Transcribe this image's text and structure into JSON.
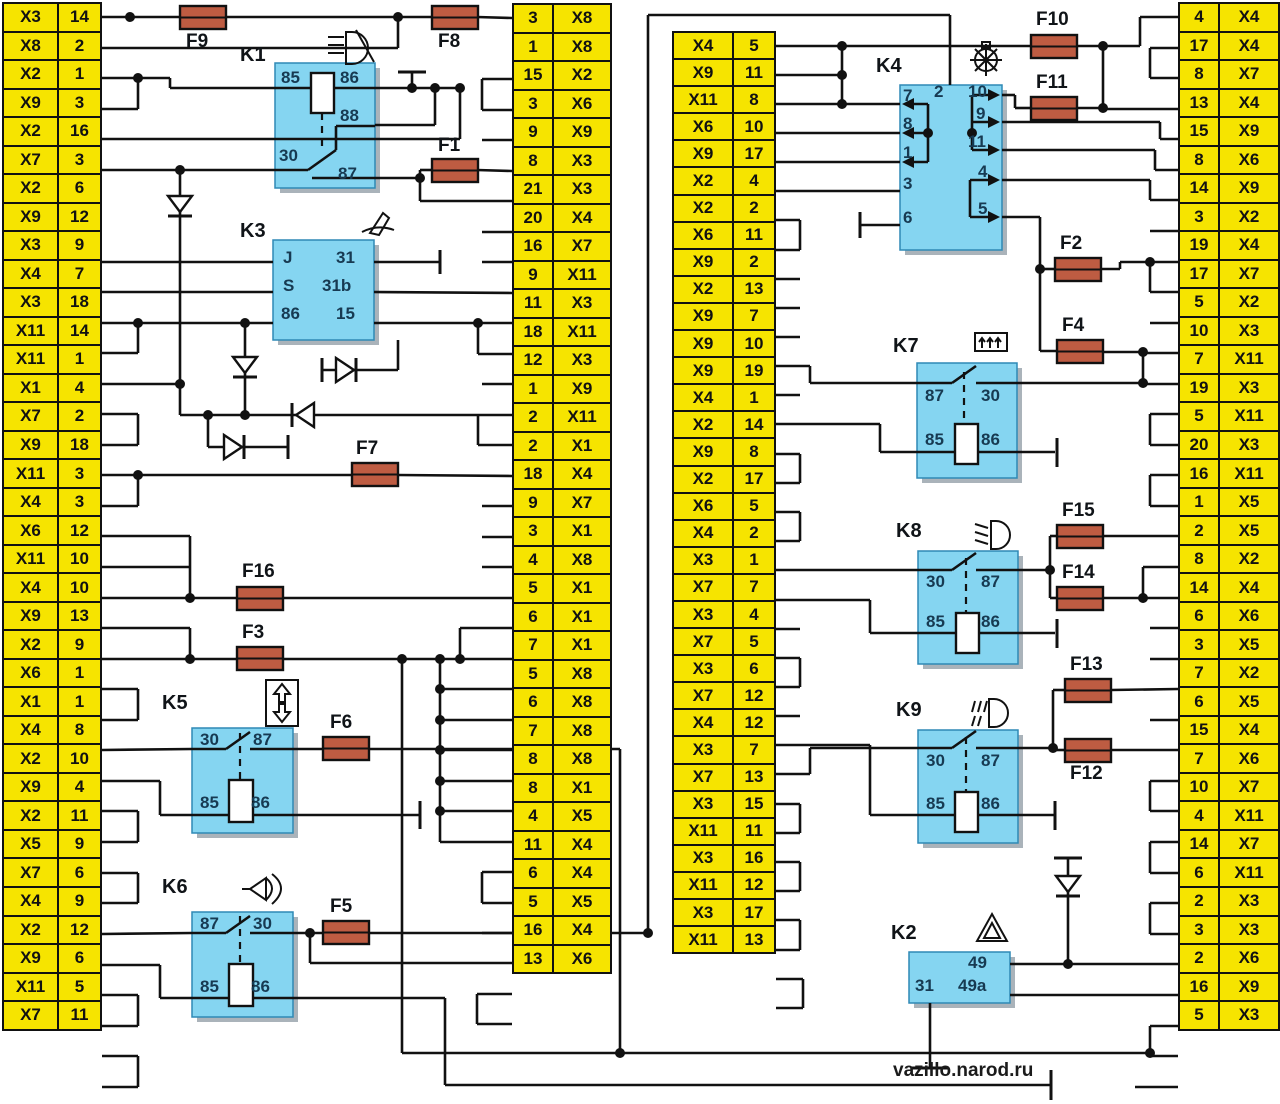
{
  "watermark": "vazillo.narod.ru",
  "colors": {
    "connector_yellow": "#F6E400",
    "relay_blue": "#85D5F1",
    "fuse_brown": "#BE5C42",
    "wire_black": "#111111",
    "background": "#FFFFFF"
  },
  "connector_columns": {
    "left": [
      {
        "conn": "X3",
        "pin": "14"
      },
      {
        "conn": "X8",
        "pin": "2"
      },
      {
        "conn": "X2",
        "pin": "1"
      },
      {
        "conn": "X9",
        "pin": "3"
      },
      {
        "conn": "X2",
        "pin": "16"
      },
      {
        "conn": "X7",
        "pin": "3"
      },
      {
        "conn": "X2",
        "pin": "6"
      },
      {
        "conn": "X9",
        "pin": "12"
      },
      {
        "conn": "X3",
        "pin": "9"
      },
      {
        "conn": "X4",
        "pin": "7"
      },
      {
        "conn": "X3",
        "pin": "18"
      },
      {
        "conn": "X11",
        "pin": "14"
      },
      {
        "conn": "X11",
        "pin": "1"
      },
      {
        "conn": "X1",
        "pin": "4"
      },
      {
        "conn": "X7",
        "pin": "2"
      },
      {
        "conn": "X9",
        "pin": "18"
      },
      {
        "conn": "X11",
        "pin": "3"
      },
      {
        "conn": "X4",
        "pin": "3"
      },
      {
        "conn": "X6",
        "pin": "12"
      },
      {
        "conn": "X11",
        "pin": "10"
      },
      {
        "conn": "X4",
        "pin": "10"
      },
      {
        "conn": "X9",
        "pin": "13"
      },
      {
        "conn": "X2",
        "pin": "9"
      },
      {
        "conn": "X6",
        "pin": "1"
      },
      {
        "conn": "X1",
        "pin": "1"
      },
      {
        "conn": "X4",
        "pin": "8"
      },
      {
        "conn": "X2",
        "pin": "10"
      },
      {
        "conn": "X9",
        "pin": "4"
      },
      {
        "conn": "X2",
        "pin": "11"
      },
      {
        "conn": "X5",
        "pin": "9"
      },
      {
        "conn": "X7",
        "pin": "6"
      },
      {
        "conn": "X4",
        "pin": "9"
      },
      {
        "conn": "X2",
        "pin": "12"
      },
      {
        "conn": "X9",
        "pin": "6"
      },
      {
        "conn": "X11",
        "pin": "5"
      },
      {
        "conn": "X7",
        "pin": "11"
      }
    ],
    "mid_left": [
      {
        "pin": "3",
        "conn": "X8"
      },
      {
        "pin": "1",
        "conn": "X8"
      },
      {
        "pin": "15",
        "conn": "X2"
      },
      {
        "pin": "3",
        "conn": "X6"
      },
      {
        "pin": "9",
        "conn": "X9"
      },
      {
        "pin": "8",
        "conn": "X3"
      },
      {
        "pin": "21",
        "conn": "X3"
      },
      {
        "pin": "20",
        "conn": "X4"
      },
      {
        "pin": "16",
        "conn": "X7"
      },
      {
        "pin": "9",
        "conn": "X11"
      },
      {
        "pin": "11",
        "conn": "X3"
      },
      {
        "pin": "18",
        "conn": "X11"
      },
      {
        "pin": "12",
        "conn": "X3"
      },
      {
        "pin": "1",
        "conn": "X9"
      },
      {
        "pin": "2",
        "conn": "X11"
      },
      {
        "pin": "2",
        "conn": "X1"
      },
      {
        "pin": "18",
        "conn": "X4"
      },
      {
        "pin": "9",
        "conn": "X7"
      },
      {
        "pin": "3",
        "conn": "X1"
      },
      {
        "pin": "4",
        "conn": "X8"
      },
      {
        "pin": "5",
        "conn": "X1"
      },
      {
        "pin": "6",
        "conn": "X1"
      },
      {
        "pin": "7",
        "conn": "X1"
      },
      {
        "pin": "5",
        "conn": "X8"
      },
      {
        "pin": "6",
        "conn": "X8"
      },
      {
        "pin": "7",
        "conn": "X8"
      },
      {
        "pin": "8",
        "conn": "X8"
      },
      {
        "pin": "8",
        "conn": "X1"
      },
      {
        "pin": "4",
        "conn": "X5"
      },
      {
        "pin": "11",
        "conn": "X4"
      },
      {
        "pin": "6",
        "conn": "X4"
      },
      {
        "pin": "5",
        "conn": "X5"
      },
      {
        "pin": "16",
        "conn": "X4"
      },
      {
        "pin": "13",
        "conn": "X6"
      }
    ],
    "mid_right": [
      {
        "conn": "X4",
        "pin": "5"
      },
      {
        "conn": "X9",
        "pin": "11"
      },
      {
        "conn": "X11",
        "pin": "8"
      },
      {
        "conn": "X6",
        "pin": "10"
      },
      {
        "conn": "X9",
        "pin": "17"
      },
      {
        "conn": "X2",
        "pin": "4"
      },
      {
        "conn": "X2",
        "pin": "2"
      },
      {
        "conn": "X6",
        "pin": "11"
      },
      {
        "conn": "X9",
        "pin": "2"
      },
      {
        "conn": "X2",
        "pin": "13"
      },
      {
        "conn": "X9",
        "pin": "7"
      },
      {
        "conn": "X9",
        "pin": "10"
      },
      {
        "conn": "X9",
        "pin": "19"
      },
      {
        "conn": "X4",
        "pin": "1"
      },
      {
        "conn": "X2",
        "pin": "14"
      },
      {
        "conn": "X9",
        "pin": "8"
      },
      {
        "conn": "X2",
        "pin": "17"
      },
      {
        "conn": "X6",
        "pin": "5"
      },
      {
        "conn": "X4",
        "pin": "2"
      },
      {
        "conn": "X3",
        "pin": "1"
      },
      {
        "conn": "X7",
        "pin": "7"
      },
      {
        "conn": "X3",
        "pin": "4"
      },
      {
        "conn": "X7",
        "pin": "5"
      },
      {
        "conn": "X3",
        "pin": "6"
      },
      {
        "conn": "X7",
        "pin": "12"
      },
      {
        "conn": "X4",
        "pin": "12"
      },
      {
        "conn": "X3",
        "pin": "7"
      },
      {
        "conn": "X7",
        "pin": "13"
      },
      {
        "conn": "X3",
        "pin": "15"
      },
      {
        "conn": "X11",
        "pin": "11"
      },
      {
        "conn": "X3",
        "pin": "16"
      },
      {
        "conn": "X11",
        "pin": "12"
      },
      {
        "conn": "X3",
        "pin": "17"
      },
      {
        "conn": "X11",
        "pin": "13"
      }
    ],
    "right": [
      {
        "pin": "4",
        "conn": "X4"
      },
      {
        "pin": "17",
        "conn": "X4"
      },
      {
        "pin": "8",
        "conn": "X7"
      },
      {
        "pin": "13",
        "conn": "X4"
      },
      {
        "pin": "15",
        "conn": "X9"
      },
      {
        "pin": "8",
        "conn": "X6"
      },
      {
        "pin": "14",
        "conn": "X9"
      },
      {
        "pin": "3",
        "conn": "X2"
      },
      {
        "pin": "19",
        "conn": "X4"
      },
      {
        "pin": "17",
        "conn": "X7"
      },
      {
        "pin": "5",
        "conn": "X2"
      },
      {
        "pin": "10",
        "conn": "X3"
      },
      {
        "pin": "7",
        "conn": "X11"
      },
      {
        "pin": "19",
        "conn": "X3"
      },
      {
        "pin": "5",
        "conn": "X11"
      },
      {
        "pin": "20",
        "conn": "X3"
      },
      {
        "pin": "16",
        "conn": "X11"
      },
      {
        "pin": "1",
        "conn": "X5"
      },
      {
        "pin": "2",
        "conn": "X5"
      },
      {
        "pin": "8",
        "conn": "X2"
      },
      {
        "pin": "14",
        "conn": "X4"
      },
      {
        "pin": "6",
        "conn": "X6"
      },
      {
        "pin": "3",
        "conn": "X5"
      },
      {
        "pin": "7",
        "conn": "X2"
      },
      {
        "pin": "6",
        "conn": "X5"
      },
      {
        "pin": "15",
        "conn": "X4"
      },
      {
        "pin": "7",
        "conn": "X6"
      },
      {
        "pin": "10",
        "conn": "X7"
      },
      {
        "pin": "4",
        "conn": "X11"
      },
      {
        "pin": "14",
        "conn": "X7"
      },
      {
        "pin": "6",
        "conn": "X11"
      },
      {
        "pin": "2",
        "conn": "X3"
      },
      {
        "pin": "3",
        "conn": "X3"
      },
      {
        "pin": "2",
        "conn": "X6"
      },
      {
        "pin": "16",
        "conn": "X9"
      },
      {
        "pin": "5",
        "conn": "X3"
      }
    ]
  },
  "relays": {
    "K1": {
      "name": "K1",
      "icon": "high-beam-headlight-icon",
      "terminals": [
        "85",
        "86",
        "88",
        "30",
        "87"
      ]
    },
    "K3": {
      "name": "K3",
      "icon": "wiper-icon",
      "terminals": [
        "J",
        "31",
        "S",
        "31b",
        "86",
        "15"
      ]
    },
    "K5": {
      "name": "K5",
      "icon": "power-window-icon",
      "terminals": [
        "30",
        "87",
        "85",
        "86"
      ]
    },
    "K6": {
      "name": "K6",
      "icon": "horn-icon",
      "terminals": [
        "87",
        "30",
        "85",
        "86"
      ]
    },
    "K4": {
      "name": "K4",
      "icon": "washer-fan-icon",
      "terminals": [
        "7",
        "2",
        "10",
        "8",
        "9",
        "1",
        "11",
        "3",
        "4",
        "5",
        "6"
      ]
    },
    "K7": {
      "name": "K7",
      "icon": "rear-defroster-icon",
      "terminals": [
        "87",
        "30",
        "85",
        "86"
      ]
    },
    "K8": {
      "name": "K8",
      "icon": "low-beam-headlight-icon",
      "terminals": [
        "30",
        "87",
        "85",
        "86"
      ]
    },
    "K9": {
      "name": "K9",
      "icon": "fog-light-icon",
      "terminals": [
        "30",
        "87",
        "85",
        "86"
      ]
    },
    "K2": {
      "name": "K2",
      "icon": "hazard-warning-icon",
      "terminals": [
        "49",
        "31",
        "49a"
      ]
    }
  },
  "fuses": [
    {
      "id": "F1",
      "label": "F1"
    },
    {
      "id": "F2",
      "label": "F2"
    },
    {
      "id": "F3",
      "label": "F3"
    },
    {
      "id": "F4",
      "label": "F4"
    },
    {
      "id": "F5",
      "label": "F5"
    },
    {
      "id": "F6",
      "label": "F6"
    },
    {
      "id": "F7",
      "label": "F7"
    },
    {
      "id": "F8",
      "label": "F8"
    },
    {
      "id": "F9",
      "label": "F9"
    },
    {
      "id": "F10",
      "label": "F10"
    },
    {
      "id": "F11",
      "label": "F11"
    },
    {
      "id": "F12",
      "label": "F12"
    },
    {
      "id": "F13",
      "label": "F13"
    },
    {
      "id": "F14",
      "label": "F14"
    },
    {
      "id": "F15",
      "label": "F15"
    },
    {
      "id": "F16",
      "label": "F16"
    }
  ]
}
